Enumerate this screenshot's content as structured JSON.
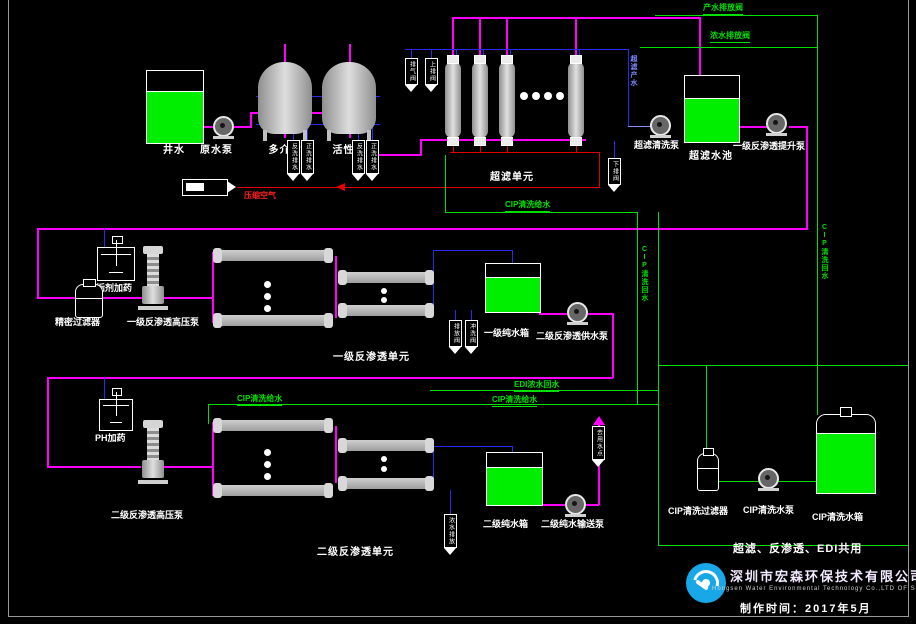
{
  "diagram": {
    "labels": {
      "raw_water_tank": "井水",
      "raw_water_pump": "原水泵",
      "multimedia_filter": "多介质",
      "activated_carbon": "活性炭",
      "uf_unit": "超滤单元",
      "uf_clean_pump": "超滤清洗泵",
      "uf_tank": "超滤水池",
      "ro1_lift_pump": "一级反渗透提升泵",
      "antiscalant_dosing": "阻垢剂加药",
      "precision_filter": "精密过滤器",
      "ro1_hp_pump": "一级反渗透高压泵",
      "ro1_unit": "一级反渗透单元",
      "ro1_pure_tank": "一级纯水箱",
      "ro2_feed_pump": "二级反渗透供水泵",
      "ph_dosing": "PH加药",
      "ro2_hp_pump": "二级反渗透高压泵",
      "ro2_unit": "二级反渗透单元",
      "ro2_pure_tank": "二级纯水箱",
      "ro2_transfer_pump": "二级纯水输送泵",
      "cip_filter": "CIP清洗过滤器",
      "cip_pump": "CIP清洗水泵",
      "cip_tank": "CIP清洗水箱"
    },
    "line_labels": {
      "product_drain": "产水排放阀",
      "concentrate_drain": "浓水排放阀",
      "compressed_air": "压缩空气",
      "uf_product": "超滤产水",
      "cip_feed_uf": "CIP清洗给水",
      "cip_feed_ro1": "CIP清洗给水",
      "cip_feed_ro2": "CIP清洗给水",
      "cip_return_right": "CIP清洗回水",
      "cip_return_mid": "CIP清洗回水",
      "edi_concentrate": "EDI浓水回水"
    },
    "valve_tags": {
      "uf_air_vent": "排气阀",
      "uf_top_drain": "上排阀",
      "uf_bottom_drain": "下排阀",
      "mm_backwash": "反洗排水",
      "mm_rinse": "正洗排水",
      "ac_backwash": "反洗排水",
      "ac_rinse": "正洗排水",
      "ro1_drain": "排放阀",
      "ro1_flush": "冲洗阀",
      "ro2_drain": "浓水排放",
      "use_point": "去用水点"
    },
    "notes": {
      "shared": "超滤、反渗透、EDI共用"
    },
    "footer": {
      "company_cn": "深圳市宏森环保技术有限公司",
      "company_en": "Hongsen Water Environmental Technology Co.,LTD OF Shenzhen",
      "made_date": "制作时间：2017年5月"
    },
    "colors": {
      "pipe_magenta": "#ff00ff",
      "pipe_blue": "#2a2aee",
      "pipe_green": "#00e000",
      "pipe_red": "#e00000",
      "tank_fill": "#00ee00",
      "vessel_gray": "#c0c0c0",
      "logo_blue": "#18a8e8"
    }
  }
}
